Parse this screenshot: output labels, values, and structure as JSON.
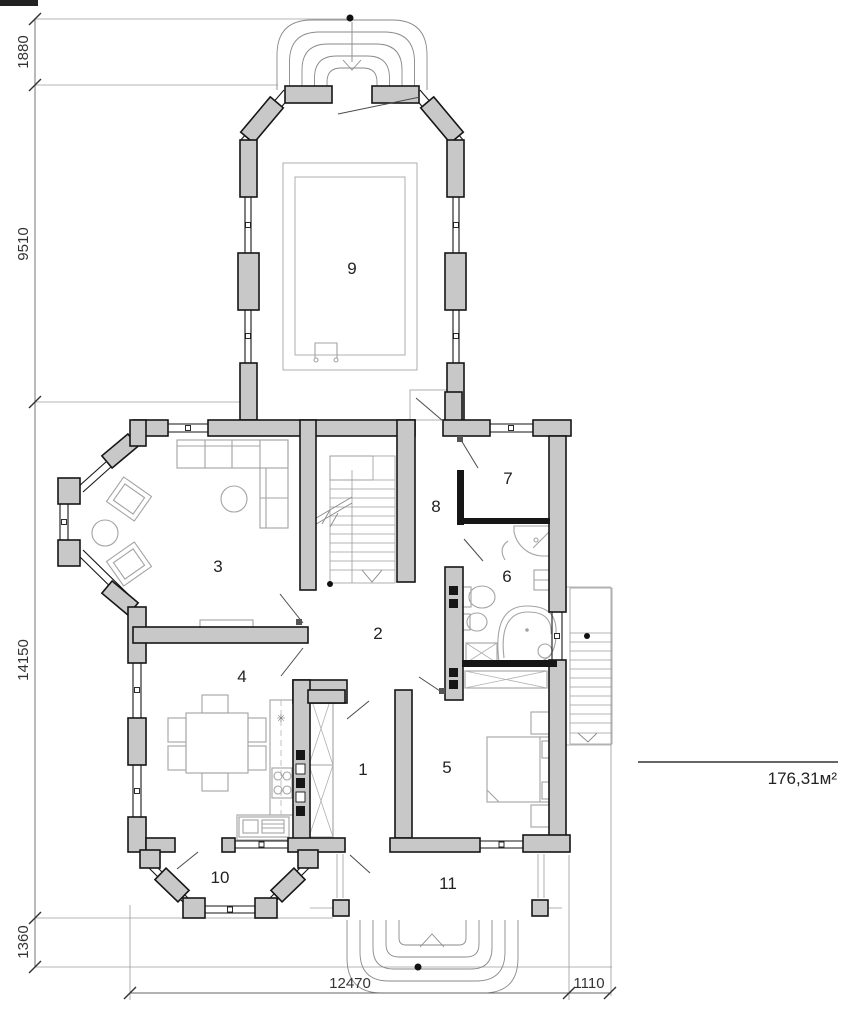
{
  "drawing": {
    "type": "house-floor-plan",
    "area_label": "176,31м²",
    "rooms": [
      {
        "number": "1"
      },
      {
        "number": "2"
      },
      {
        "number": "3"
      },
      {
        "number": "4"
      },
      {
        "number": "5"
      },
      {
        "number": "6"
      },
      {
        "number": "7"
      },
      {
        "number": "8"
      },
      {
        "number": "9"
      },
      {
        "number": "10"
      },
      {
        "number": "11"
      }
    ],
    "dimensions": {
      "left": [
        "1880",
        "9510",
        "14150",
        "1360"
      ],
      "bottom": [
        "12470",
        "1110"
      ]
    },
    "colors": {
      "wall_fill": "#c8c8c8",
      "wall_stroke": "#161616",
      "thin_line": "#9b9b9b",
      "dimension": "#666666",
      "text": "#222222"
    }
  }
}
